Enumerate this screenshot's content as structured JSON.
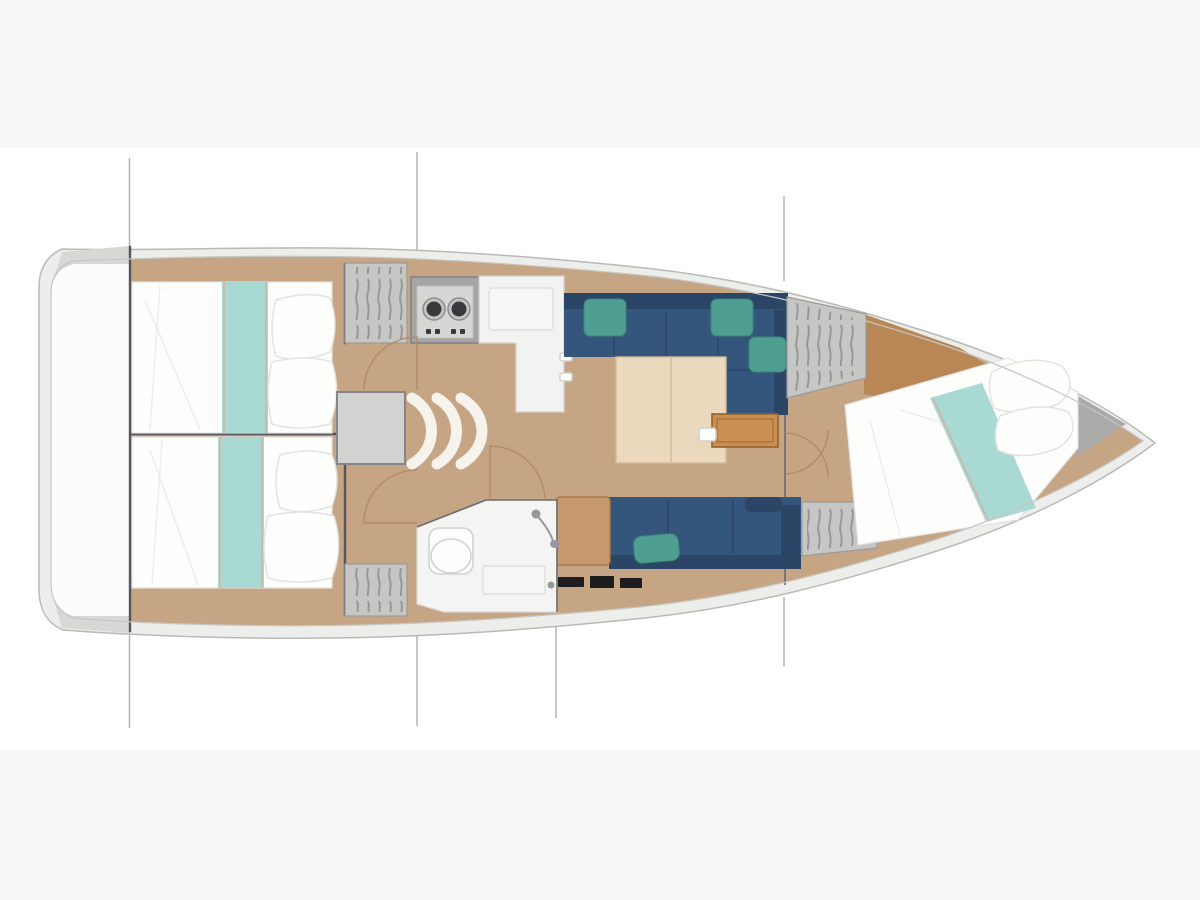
{
  "title": "Sailboat interior layout — top-view floor plan",
  "image_type": "boat-floorplan-illustration",
  "visible_text": [],
  "colors": {
    "bg": "#ffffff",
    "bg_band": "#f8f8f8",
    "hull_band": "#ededeb",
    "hull_stroke": "#b9b9b6",
    "interior_white": "#fcfcfb",
    "section_line": "#a6a6a4",
    "wall_dark": "#55555a",
    "wood_floor": "#c6a585",
    "wood_dark": "#b98756",
    "wood_table": "#ead9bc",
    "wood_side_table": "#c98e52",
    "seat_tan": "#c69a6d",
    "bed_white": "#fdfdfc",
    "blanket_aqua": "#a9d9d3",
    "blanket_line_coral": "#dca79e",
    "sofa_blue": "#35567c",
    "sofa_blue_dark": "#2a4565",
    "cushion_teal": "#4f9e92",
    "locker_gray": "#c6c6c4",
    "locker_slat": "#8e8e90",
    "steps_gray": "#d2d2d0",
    "counter_white": "#f2f2f1",
    "stove_dark": "#3a3a3e",
    "black_equipment": "#1d1d1f",
    "anchor_gray": "#aaaaa8"
  },
  "components": [
    "hull-outline",
    "section-lines",
    "transom-stern-locker",
    "aft-cabin-port-double-berth",
    "aft-cabin-starboard-double-berth",
    "hanging-lockers-with-hangers",
    "companionway-steps",
    "engine-box",
    "galley-two-burner-stove",
    "galley-l-shaped-counter-with-sink",
    "salon-l-shaped-sofa-starboard",
    "salon-straight-sofa-port",
    "salon-folding-table",
    "wooden-side-table",
    "nav-seat",
    "head-with-toilet-sink-shower",
    "door-swing-arcs",
    "forward-cabin-island-berth",
    "bow-anchor-locker"
  ]
}
